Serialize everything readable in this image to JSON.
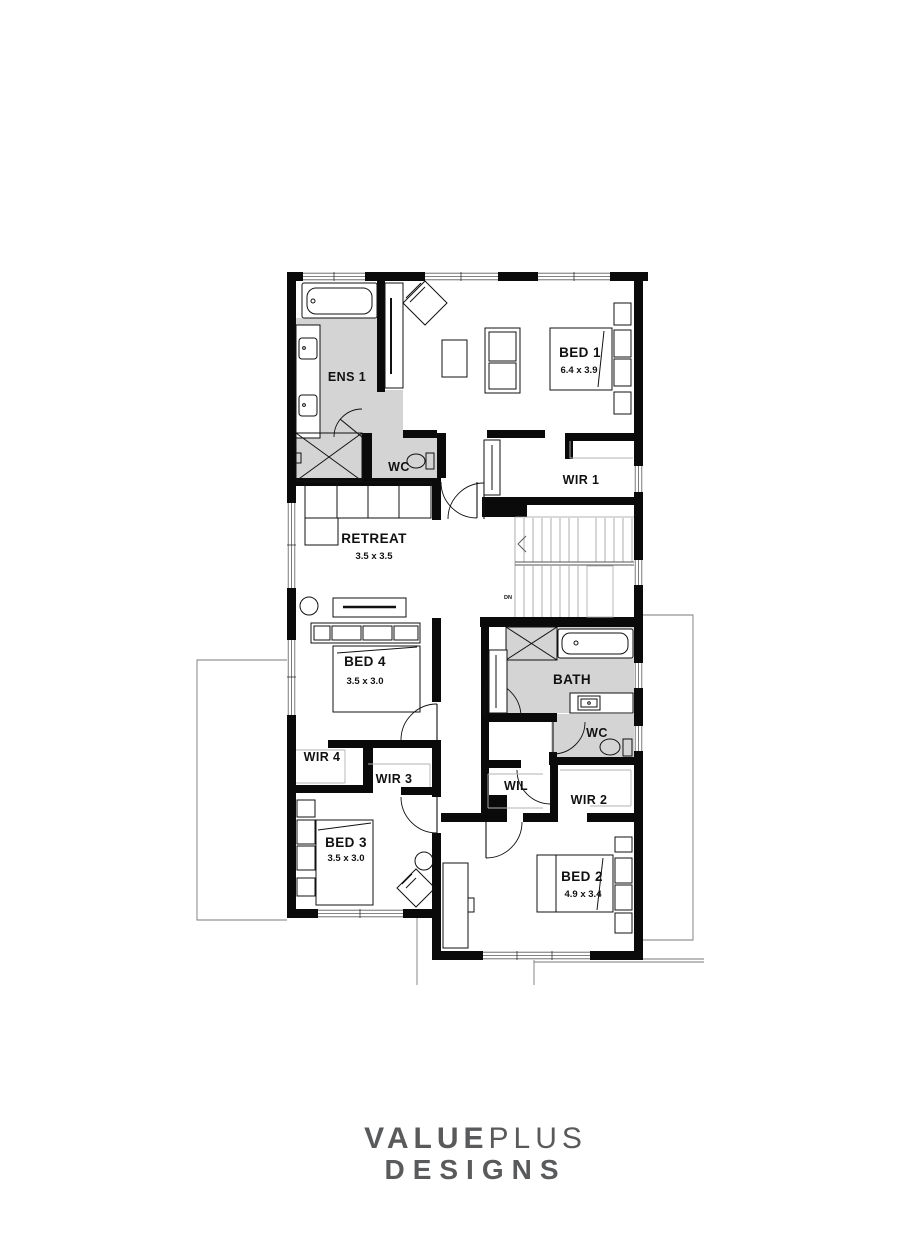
{
  "plan": {
    "rooms": [
      {
        "name": "ENS 1"
      },
      {
        "name": "WC"
      },
      {
        "name": "BED 1",
        "dims": "6.4 x 3.9"
      },
      {
        "name": "WIR 1"
      },
      {
        "name": "RETREAT",
        "dims": "3.5 x 3.5"
      },
      {
        "name": "BED 4",
        "dims": "3.5 x 3.0"
      },
      {
        "name": "BATH"
      },
      {
        "name": "WC"
      },
      {
        "name": "WIR 4"
      },
      {
        "name": "WIR 3"
      },
      {
        "name": "WIL"
      },
      {
        "name": "WIR 2"
      },
      {
        "name": "BED 3",
        "dims": "3.5 x 3.0"
      },
      {
        "name": "BED 2",
        "dims": "4.9 x 3.4"
      }
    ],
    "stairs": {
      "label": "DN"
    }
  },
  "brand": {
    "word1": "VALUE",
    "word2": "PLUS",
    "word3": "DESIGNS",
    "color": "#595a5c"
  },
  "colors": {
    "wall": "#0a0a0a",
    "wet_area_floor": "#d4d4d4",
    "shelf_outline": "#b3b3b3",
    "roof_outline": "#7a7a7a"
  }
}
